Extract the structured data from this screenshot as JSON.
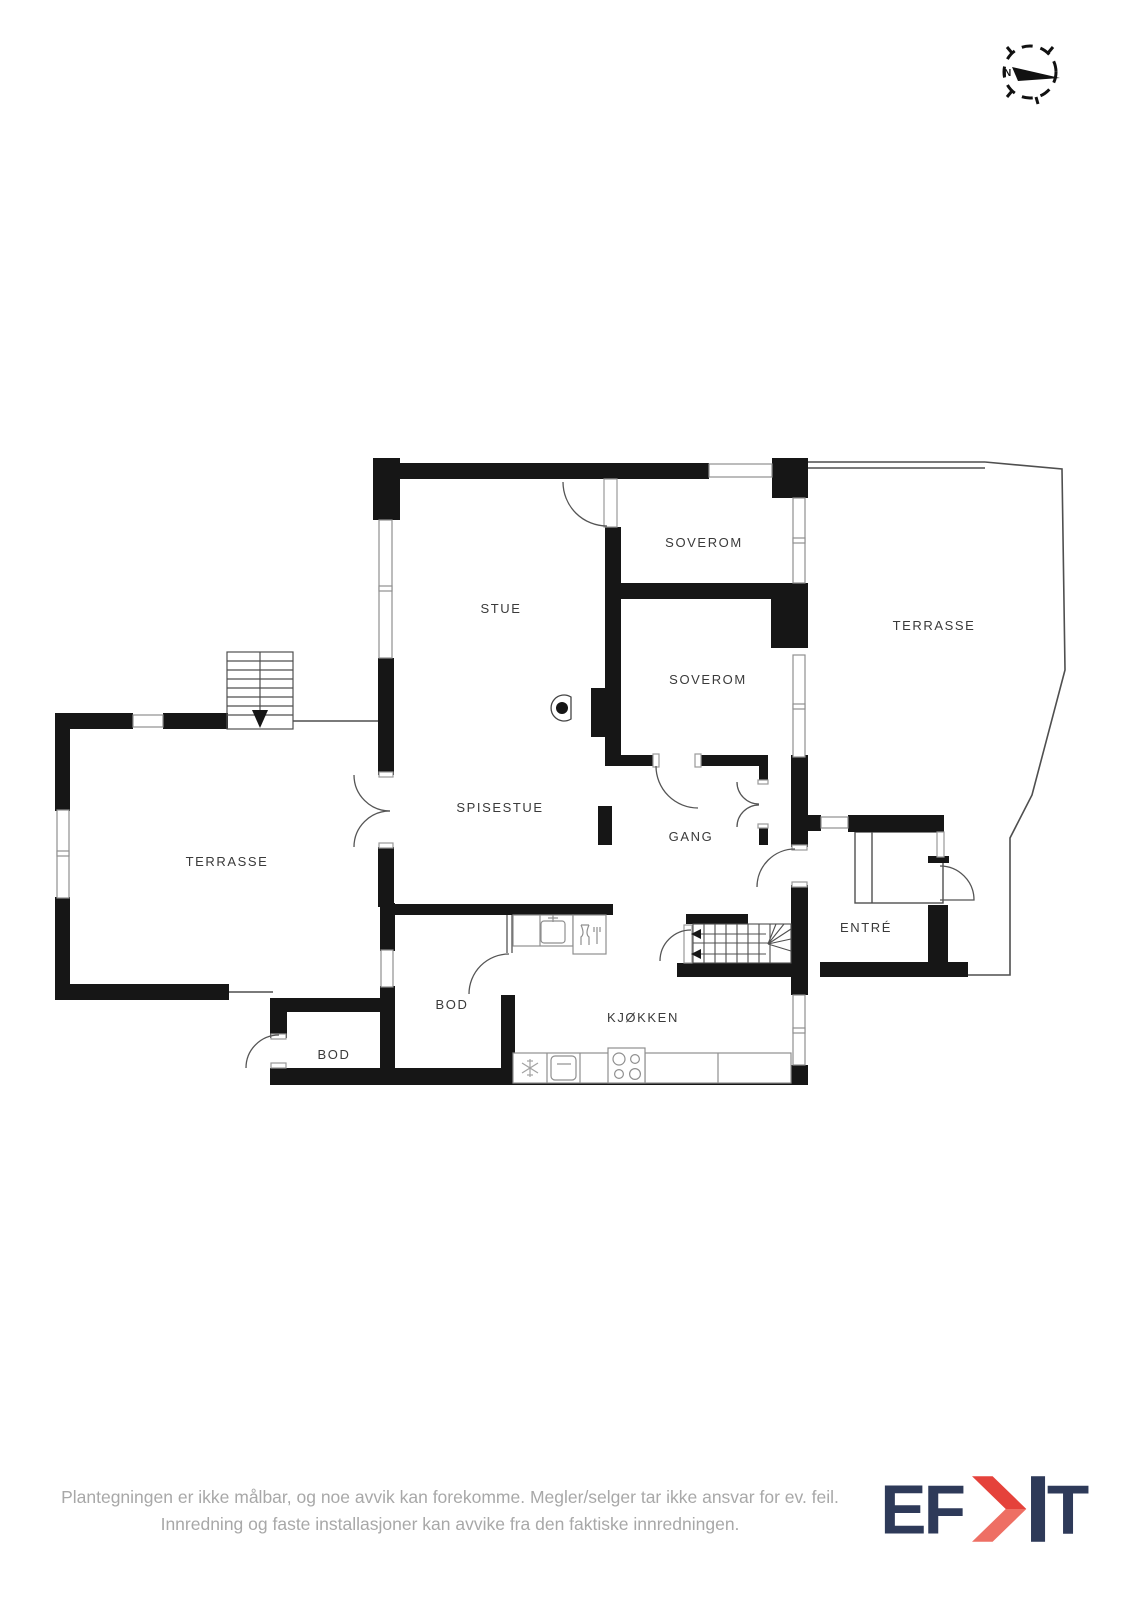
{
  "compass": {
    "north_label": "N"
  },
  "floorplan": {
    "rooms": [
      {
        "id": "stue",
        "label": "STUE"
      },
      {
        "id": "soverom-1",
        "label": "SOVEROM"
      },
      {
        "id": "soverom-2",
        "label": "SOVEROM"
      },
      {
        "id": "terrasse-right",
        "label": "TERRASSE"
      },
      {
        "id": "terrasse-left",
        "label": "TERRASSE"
      },
      {
        "id": "spisestue",
        "label": "SPISESTUE"
      },
      {
        "id": "gang",
        "label": "GANG"
      },
      {
        "id": "entre",
        "label": "ENTRÉ"
      },
      {
        "id": "bod-inner",
        "label": "BOD"
      },
      {
        "id": "bod-outer",
        "label": "BOD"
      },
      {
        "id": "kjokken",
        "label": "KJØKKEN"
      }
    ]
  },
  "footer": {
    "disclaimer_line1": "Plantegningen er ikke målbar, og noe avvik kan forekomme. Megler/selger tar ikke ansvar for ev. feil.",
    "disclaimer_line2": "Innredning og faste installasjoner kan avvike fra den faktiske innredningen.",
    "logo": {
      "text": "EFKT",
      "part1": "EF",
      "part2": "T"
    }
  },
  "colors": {
    "wall": "#161616",
    "thin_line": "#4f4f4f",
    "fixture": "#8f8f8f",
    "label": "#3a3a3a",
    "disclaimer": "#a8a8a8",
    "logo_navy": "#2e3a59",
    "logo_red": "#e5423b",
    "logo_red_light": "#ee6f64"
  }
}
